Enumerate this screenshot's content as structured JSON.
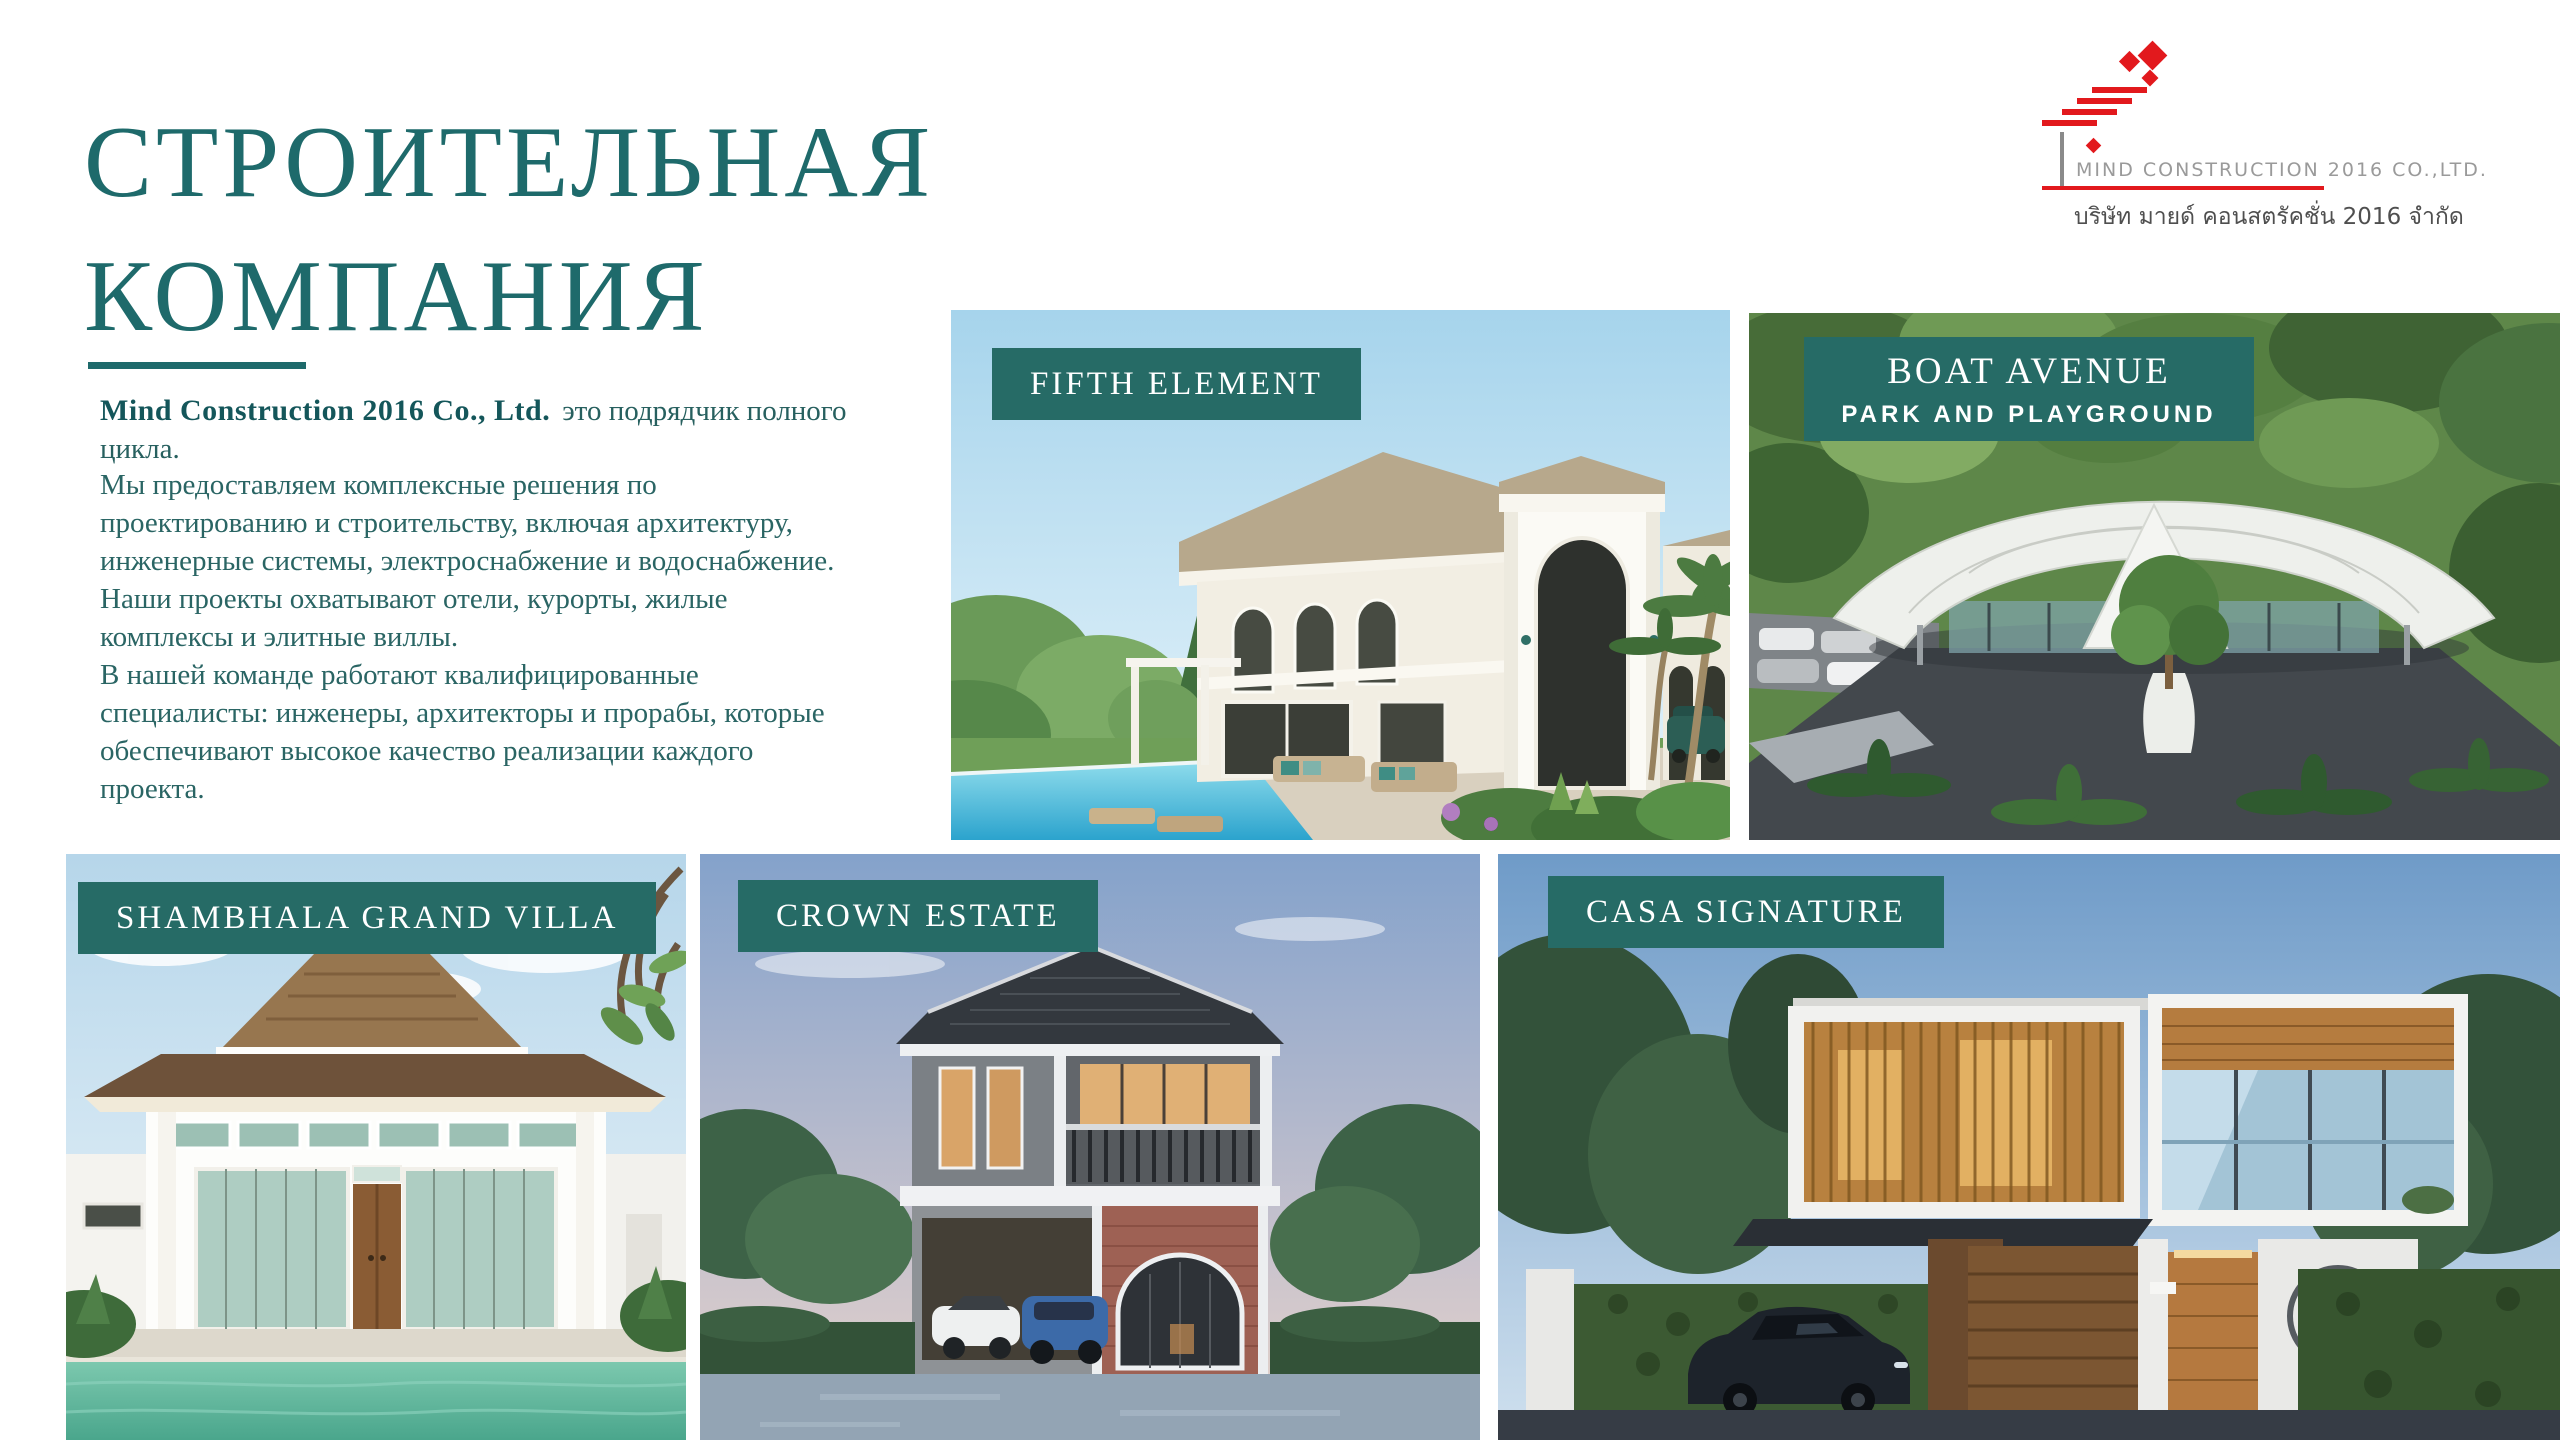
{
  "slide": {
    "title_line1": "СТРОИТЕЛЬНАЯ",
    "title_line2": "КОМПАНИЯ",
    "accent_color": "#1E6A6B",
    "badge_color": "#266B66"
  },
  "logo": {
    "company_en": "MIND CONSTRUCTION 2016 CO.,LTD.",
    "company_th": "บริษัท มายด์ คอนสตรัคชั่น 2016 จำกัด",
    "mark_color": "#E2191D",
    "text_color": "#9A9A9A"
  },
  "about": {
    "intro_bold": "Mind Construction 2016 Co., Ltd.",
    "intro_rest": "это подрядчик полного цикла.",
    "paragraph1": "Мы предоставляем комплексные решения по проектированию и строительству, включая архитектуру, инженерные системы, электроснабжение и водоснабжение. Наши проекты охватывают отели, курорты, жилые комплексы и элитные виллы.",
    "paragraph2": "В нашей команде работают квалифицированные специалисты: инженеры, архитекторы и прорабы, которые обеспечивают высокое качество реализации каждого проекта."
  },
  "projects": [
    {
      "label": "FIFTH ELEMENT"
    },
    {
      "label": "BOAT AVENUE",
      "sublabel": "PARK AND PLAYGROUND"
    },
    {
      "label": "SHAMBHALA GRAND VILLA"
    },
    {
      "label": "CROWN ESTATE"
    },
    {
      "label": "CASA SIGNATURE"
    }
  ]
}
